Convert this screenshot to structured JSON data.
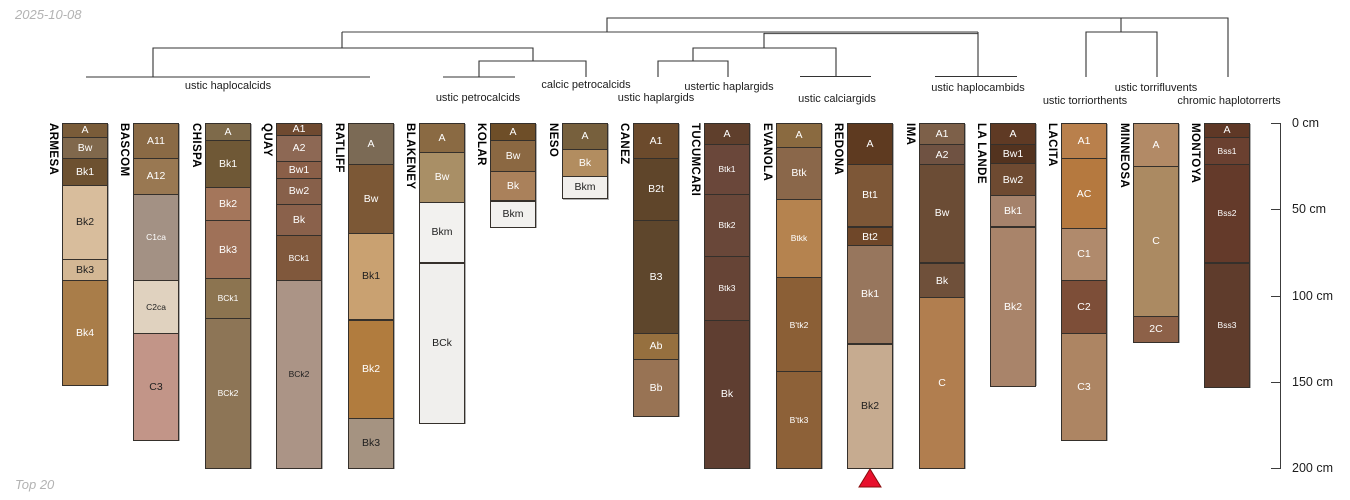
{
  "meta": {
    "date_label": "2025-10-08",
    "caption": "Top 20"
  },
  "chart_data": {
    "type": "soil-profile-dendrogram",
    "description": "Dendrogram of 17 soil series profiles with horizon sketches by depth",
    "depth_axis": {
      "unit": "cm",
      "max_depth": 200,
      "ticks": [
        {
          "value": 0,
          "label": "0 cm"
        },
        {
          "value": 50,
          "label": "50 cm"
        },
        {
          "value": 100,
          "label": "100 cm"
        },
        {
          "value": 150,
          "label": "150 cm"
        },
        {
          "value": 200,
          "label": "200 cm"
        }
      ]
    },
    "clusters": [
      {
        "label": "ustic haplocalcids",
        "x": 228,
        "y": 80
      },
      {
        "label": "ustic petrocalcids",
        "x": 478,
        "y": 92
      },
      {
        "label": "calcic petrocalcids",
        "x": 586,
        "y": 79
      },
      {
        "label": "ustic haplargids",
        "x": 656,
        "y": 92
      },
      {
        "label": "ustertic haplargids",
        "x": 729,
        "y": 81
      },
      {
        "label": "ustic calciargids",
        "x": 837,
        "y": 93
      },
      {
        "label": "ustic haplocambids",
        "x": 978,
        "y": 82
      },
      {
        "label": "ustic torriorthents",
        "x": 1085,
        "y": 95
      },
      {
        "label": "ustic torrifluvents",
        "x": 1156,
        "y": 82
      },
      {
        "label": "chromic haplotorrerts",
        "x": 1229,
        "y": 95
      }
    ],
    "profiles": [
      {
        "name": "ARMESA",
        "horizons": [
          {
            "label": "A",
            "top": 0,
            "bottom": 8,
            "color": "#7a5c39"
          },
          {
            "label": "Bw",
            "top": 8,
            "bottom": 20,
            "color": "#80684c"
          },
          {
            "label": "Bk1",
            "top": 20,
            "bottom": 36,
            "color": "#6d5130"
          },
          {
            "label": "Bk2",
            "top": 36,
            "bottom": 79,
            "color": "#d8bd9c"
          },
          {
            "label": "Bk3",
            "top": 79,
            "bottom": 91,
            "color": "#d3b794"
          },
          {
            "label": "Bk4",
            "top": 91,
            "bottom": 152,
            "color": "#a97d49"
          }
        ]
      },
      {
        "name": "BASCOM",
        "horizons": [
          {
            "label": "A11",
            "top": 0,
            "bottom": 20,
            "color": "#8a6a45"
          },
          {
            "label": "A12",
            "top": 20,
            "bottom": 41,
            "color": "#997852"
          },
          {
            "label": "C1ca",
            "top": 41,
            "bottom": 91,
            "color": "#a39184"
          },
          {
            "label": "C2ca",
            "top": 91,
            "bottom": 122,
            "color": "#e0d2bf"
          },
          {
            "label": "C3",
            "top": 122,
            "bottom": 184,
            "color": "#c29588"
          }
        ]
      },
      {
        "name": "CHISPA",
        "horizons": [
          {
            "label": "A",
            "top": 0,
            "bottom": 10,
            "color": "#7e6a4a"
          },
          {
            "label": "Bk1",
            "top": 10,
            "bottom": 37,
            "color": "#6f5836"
          },
          {
            "label": "Bk2",
            "top": 37,
            "bottom": 56,
            "color": "#a4765b"
          },
          {
            "label": "Bk3",
            "top": 56,
            "bottom": 90,
            "color": "#9f7158"
          },
          {
            "label": "BCk1",
            "top": 90,
            "bottom": 113,
            "color": "#8c7450"
          },
          {
            "label": "BCk2",
            "top": 113,
            "bottom": 200,
            "color": "#8d7556"
          }
        ]
      },
      {
        "name": "QUAY",
        "horizons": [
          {
            "label": "A1",
            "top": 0,
            "bottom": 7,
            "color": "#6f4a30"
          },
          {
            "label": "A2",
            "top": 7,
            "bottom": 22,
            "color": "#8d6854"
          },
          {
            "label": "Bw1",
            "top": 22,
            "bottom": 32,
            "color": "#8a5f48"
          },
          {
            "label": "Bw2",
            "top": 32,
            "bottom": 47,
            "color": "#87604a"
          },
          {
            "label": "Bk",
            "top": 47,
            "bottom": 65,
            "color": "#8a614b"
          },
          {
            "label": "BCk1",
            "top": 65,
            "bottom": 91,
            "color": "#80583c"
          },
          {
            "label": "BCk2",
            "top": 91,
            "bottom": 200,
            "color": "#ab9486"
          }
        ]
      },
      {
        "name": "RATLIFF",
        "horizons": [
          {
            "label": "A",
            "top": 0,
            "bottom": 24,
            "color": "#7b6a55"
          },
          {
            "label": "Bw",
            "top": 24,
            "bottom": 64,
            "color": "#7c5836"
          },
          {
            "label": "Bk1",
            "top": 64,
            "bottom": 114,
            "color": "#c9a171"
          },
          {
            "label": "Bk2",
            "top": 114,
            "bottom": 171,
            "color": "#b17c3e"
          },
          {
            "label": "Bk3",
            "top": 171,
            "bottom": 200,
            "color": "#a59381"
          }
        ]
      },
      {
        "name": "BLAKENEY",
        "horizons": [
          {
            "label": "A",
            "top": 0,
            "bottom": 17,
            "color": "#8a6a43"
          },
          {
            "label": "Bw",
            "top": 17,
            "bottom": 46,
            "color": "#a98f66"
          },
          {
            "label": "Bkm",
            "top": 46,
            "bottom": 81,
            "color": "#f2f1ef"
          },
          {
            "label": "BCk",
            "top": 81,
            "bottom": 174,
            "color": "#f0efed"
          }
        ]
      },
      {
        "name": "KOLAR",
        "horizons": [
          {
            "label": "A",
            "top": 0,
            "bottom": 10,
            "color": "#6e4e28"
          },
          {
            "label": "Bw",
            "top": 10,
            "bottom": 28,
            "color": "#8b6842"
          },
          {
            "label": "Bk",
            "top": 28,
            "bottom": 45,
            "color": "#aa815b"
          },
          {
            "label": "Bkm",
            "top": 45,
            "bottom": 60,
            "color": "#f2f1ef"
          }
        ]
      },
      {
        "name": "NESO",
        "horizons": [
          {
            "label": "A",
            "top": 0,
            "bottom": 15,
            "color": "#77603d"
          },
          {
            "label": "Bk",
            "top": 15,
            "bottom": 31,
            "color": "#b28d60"
          },
          {
            "label": "Bkm",
            "top": 31,
            "bottom": 44,
            "color": "#f1efec"
          }
        ]
      },
      {
        "name": "CANEZ",
        "horizons": [
          {
            "label": "A1",
            "top": 0,
            "bottom": 20,
            "color": "#6b4a2c"
          },
          {
            "label": "B2t",
            "top": 20,
            "bottom": 56,
            "color": "#5f452a"
          },
          {
            "label": "B3",
            "top": 56,
            "bottom": 122,
            "color": "#5e462c"
          },
          {
            "label": "Ab",
            "top": 122,
            "bottom": 137,
            "color": "#96703f"
          },
          {
            "label": "Bb",
            "top": 137,
            "bottom": 170,
            "color": "#987354"
          }
        ]
      },
      {
        "name": "TUCUMCARI",
        "horizons": [
          {
            "label": "A",
            "top": 0,
            "bottom": 12,
            "color": "#5f3f2c"
          },
          {
            "label": "Btk1",
            "top": 12,
            "bottom": 41,
            "color": "#6a473a"
          },
          {
            "label": "Btk2",
            "top": 41,
            "bottom": 77,
            "color": "#694739"
          },
          {
            "label": "Btk3",
            "top": 77,
            "bottom": 114,
            "color": "#664436"
          },
          {
            "label": "Bk",
            "top": 114,
            "bottom": 200,
            "color": "#5f3e31"
          }
        ]
      },
      {
        "name": "EVANOLA",
        "horizons": [
          {
            "label": "A",
            "top": 0,
            "bottom": 14,
            "color": "#8a6a40"
          },
          {
            "label": "Btk",
            "top": 14,
            "bottom": 44,
            "color": "#8a674a"
          },
          {
            "label": "Btkk",
            "top": 44,
            "bottom": 89,
            "color": "#b5834f"
          },
          {
            "label": "B'tk2",
            "top": 89,
            "bottom": 144,
            "color": "#8b5f36"
          },
          {
            "label": "B'tk3",
            "top": 144,
            "bottom": 200,
            "color": "#8d6138"
          }
        ]
      },
      {
        "name": "REDONA",
        "horizons": [
          {
            "label": "A",
            "top": 0,
            "bottom": 24,
            "color": "#5e3a20"
          },
          {
            "label": "Bt1",
            "top": 24,
            "bottom": 60,
            "color": "#7d5737"
          },
          {
            "label": "Bt2",
            "top": 60,
            "bottom": 71,
            "color": "#6f4729"
          },
          {
            "label": "Bk1",
            "top": 71,
            "bottom": 128,
            "color": "#97765d"
          },
          {
            "label": "Bk2",
            "top": 128,
            "bottom": 200,
            "color": "#c6ab90"
          }
        ]
      },
      {
        "name": "IMA",
        "horizons": [
          {
            "label": "A1",
            "top": 0,
            "bottom": 12,
            "color": "#7d6049"
          },
          {
            "label": "A2",
            "top": 12,
            "bottom": 24,
            "color": "#6f5242"
          },
          {
            "label": "Bw",
            "top": 24,
            "bottom": 81,
            "color": "#6b4c35"
          },
          {
            "label": "Bk",
            "top": 81,
            "bottom": 101,
            "color": "#6f503a"
          },
          {
            "label": "C",
            "top": 101,
            "bottom": 200,
            "color": "#b17e4f"
          }
        ]
      },
      {
        "name": "LA LANDE",
        "horizons": [
          {
            "label": "A",
            "top": 0,
            "bottom": 12,
            "color": "#5f3a24"
          },
          {
            "label": "Bw1",
            "top": 12,
            "bottom": 23,
            "color": "#53331f"
          },
          {
            "label": "Bw2",
            "top": 23,
            "bottom": 42,
            "color": "#6e4a31"
          },
          {
            "label": "Bk1",
            "top": 42,
            "bottom": 60,
            "color": "#a5826b"
          },
          {
            "label": "Bk2",
            "top": 60,
            "bottom": 152,
            "color": "#a9846a"
          }
        ]
      },
      {
        "name": "LACITA",
        "horizons": [
          {
            "label": "A1",
            "top": 0,
            "bottom": 20,
            "color": "#b9804c"
          },
          {
            "label": "AC",
            "top": 20,
            "bottom": 61,
            "color": "#b5793f"
          },
          {
            "label": "C1",
            "top": 61,
            "bottom": 91,
            "color": "#b08a6c"
          },
          {
            "label": "C2",
            "top": 91,
            "bottom": 122,
            "color": "#7d4e38"
          },
          {
            "label": "C3",
            "top": 122,
            "bottom": 184,
            "color": "#ad8563"
          }
        ]
      },
      {
        "name": "MINNEOSA",
        "horizons": [
          {
            "label": "A",
            "top": 0,
            "bottom": 25,
            "color": "#b28a66"
          },
          {
            "label": "C",
            "top": 25,
            "bottom": 112,
            "color": "#ab8a62"
          },
          {
            "label": "2C",
            "top": 112,
            "bottom": 127,
            "color": "#8d6148"
          }
        ]
      },
      {
        "name": "MONTOYA",
        "horizons": [
          {
            "label": "A",
            "top": 0,
            "bottom": 8,
            "color": "#5f3826"
          },
          {
            "label": "Bss1",
            "top": 8,
            "bottom": 24,
            "color": "#6a4030"
          },
          {
            "label": "Bss2",
            "top": 24,
            "bottom": 81,
            "color": "#643a2a"
          },
          {
            "label": "Bss3",
            "top": 81,
            "bottom": 153,
            "color": "#5f3c2c"
          }
        ]
      }
    ],
    "marker": {
      "profile": "REDONA",
      "shape": "triangle-up",
      "color": "#e8112d"
    },
    "line_colors": {
      "tree": "#333333",
      "tree_upper": "#808080"
    }
  }
}
